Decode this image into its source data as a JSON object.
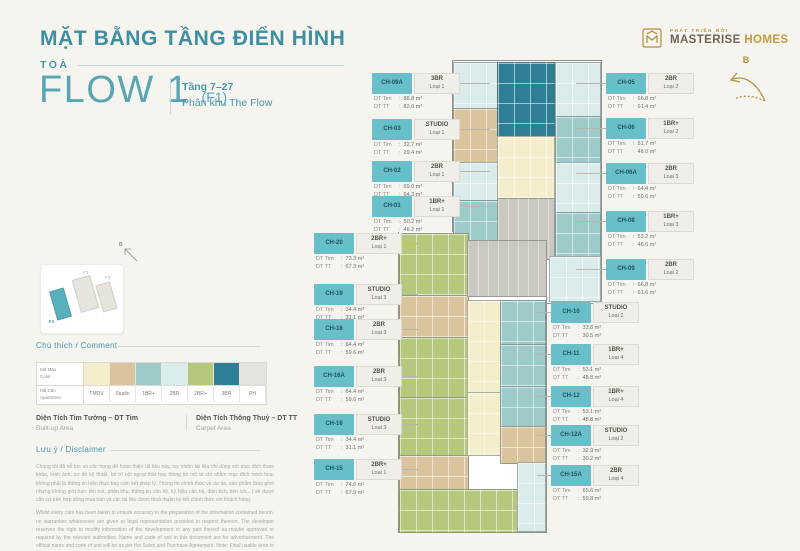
{
  "header": {
    "title": "MẶT BẰNG TẦNG ĐIỂN HÌNH",
    "tower_label": "TOÀ",
    "tower_name": "FLOW 1",
    "tower_code": "(F1)",
    "floors": "Tầng 7–27",
    "subzone": "Phân khu The Flow"
  },
  "logo": {
    "developed_by": "PHÁT TRIỂN BỞI",
    "brand_primary": "MASTERISE",
    "brand_secondary": "HOMES"
  },
  "compass": {
    "north_label": "B"
  },
  "minimap": {
    "north_label": "B",
    "buildings": [
      "F1",
      "F2",
      "F3"
    ]
  },
  "legend": {
    "heading": "Chú thích / Comment",
    "color_label_vi": "Mã Màu",
    "color_label_en": "Color",
    "apt_label_vi": "Mã Căn",
    "apt_label_en": "Apartment",
    "types": [
      {
        "label": "TMDV",
        "color": "#f5eecd"
      },
      {
        "label": "Studio",
        "color": "#d9c49d"
      },
      {
        "label": "1BR+",
        "color": "#9ccbca"
      },
      {
        "label": "2BR",
        "color": "#d9ebea"
      },
      {
        "label": "2BR+",
        "color": "#b5c87d"
      },
      {
        "label": "3BR",
        "color": "#2e7f96"
      },
      {
        "label": "PH",
        "color": "#e4e4df"
      }
    ]
  },
  "colors": {
    "core": "#cac8c0",
    "accent_teal": "#3e8fa1",
    "gold": "#b08d3f"
  },
  "measures": {
    "tim_vi": "Diện Tích Tim Tường – DT Tim",
    "tim_en": "Built-up Area",
    "tt_vi": "Diện Tích Thông Thuỷ – DT TT",
    "tt_en": "Carpet Area"
  },
  "labels": {
    "dt_tim": "DT Tim",
    "dt_tt": "DT TT",
    "colon": ":"
  },
  "disclaimer": {
    "heading": "Lưu ý / Disclaimer",
    "vi": "Chúng tôi đã nỗ lực và cẩn trọng để hoàn thiện tài liệu này, tuy nhiên tài liệu chỉ dùng với mục đích tham khảo, hình ảnh, sơ đồ kỹ thuật, bố trí nội ngoại thất hay thông tin mô tả chỉ nhằm mục đích minh hoạ, không phải là thông tin hiện thực hay cam kết pháp lý. Thông tin chính thức về dự án, sản phẩm (bao gồm nhưng không giới hạn: tên toà, phân khu, thông tin căn hộ, ký hiệu căn hộ, diện tích, tiện ích,...) sẽ được căn cứ trên hợp đồng mua bán và các tài liệu được thoả thuận ký kết chính thức với khách hàng.",
    "en": "Whilst every care has been taken to ensure accuracy in the preparation of the information contained herein, no warranties whatsoever are given or legal representation provided in respect thereon. The developer reserves the right to modify information of the development or any part thereof as maybe approved or required by the relevant authorities. Name and code of unit in this document are for advertisement. The official name and code of unit will be as per the Sales and Purchase Agreement. Note: Final usable area to be verified by surveyor."
  },
  "units": [
    {
      "code": "CH-09A",
      "type": "3BR",
      "variant": "Loại 1",
      "dt_tim": "88.8 m²",
      "dt_tt": "82.6 m²"
    },
    {
      "code": "CH-03",
      "type": "STUDIO",
      "variant": "Loại 1",
      "dt_tim": "32.7 m²",
      "dt_tt": "29.4 m²"
    },
    {
      "code": "CH-02",
      "type": "2BR",
      "variant": "Loại 1",
      "dt_tim": "69.0 m²",
      "dt_tt": "64.3 m²"
    },
    {
      "code": "CH-01",
      "type": "1BR+",
      "variant": "Loại 1",
      "dt_tim": "50.2 m²",
      "dt_tt": "46.2 m²"
    },
    {
      "code": "CH-20",
      "type": "2BR+",
      "variant": "Loại 1",
      "dt_tim": "73.3 m²",
      "dt_tt": "67.3 m²"
    },
    {
      "code": "CH-19",
      "type": "STUDIO",
      "variant": "Loại 3",
      "dt_tim": "34.4 m²",
      "dt_tt": "31.1 m²"
    },
    {
      "code": "CH-18",
      "type": "2BR",
      "variant": "Loại 3",
      "dt_tim": "64.4 m²",
      "dt_tt": "59.6 m²"
    },
    {
      "code": "CH-16A",
      "type": "2BR",
      "variant": "Loại 3",
      "dt_tim": "64.4 m²",
      "dt_tt": "59.6 m²"
    },
    {
      "code": "CH-16",
      "type": "STUDIO",
      "variant": "Loại 3",
      "dt_tim": "34.4 m²",
      "dt_tt": "31.1 m²"
    },
    {
      "code": "CH-15",
      "type": "2BR+",
      "variant": "Loại 1",
      "dt_tim": "74.6 m²",
      "dt_tt": "67.9 m²"
    },
    {
      "code": "CH-05",
      "type": "2BR",
      "variant": "Loại 2",
      "dt_tim": "66.8 m²",
      "dt_tt": "61.4 m²"
    },
    {
      "code": "CH-06",
      "type": "1BR+",
      "variant": "Loại 2",
      "dt_tim": "51.7 m²",
      "dt_tt": "48.0 m²"
    },
    {
      "code": "CH-06A",
      "type": "2BR",
      "variant": "Loại 3",
      "dt_tim": "64.4 m²",
      "dt_tt": "59.6 m²"
    },
    {
      "code": "CH-08",
      "type": "1BR+",
      "variant": "Loại 3",
      "dt_tim": "53.2 m²",
      "dt_tt": "48.6 m²"
    },
    {
      "code": "CH-09",
      "type": "2BR",
      "variant": "Loại 2",
      "dt_tim": "66.8 m²",
      "dt_tt": "61.6 m²"
    },
    {
      "code": "CH-10",
      "type": "STUDIO",
      "variant": "Loại 2",
      "dt_tim": "33.8 m²",
      "dt_tt": "30.5 m²"
    },
    {
      "code": "CH-11",
      "type": "1BR+",
      "variant": "Loại 4",
      "dt_tim": "53.1 m²",
      "dt_tt": "48.8 m²"
    },
    {
      "code": "CH-12",
      "type": "1BR+",
      "variant": "Loại 4",
      "dt_tim": "53.1 m²",
      "dt_tt": "48.8 m²"
    },
    {
      "code": "CH-12A",
      "type": "STUDIO",
      "variant": "Loại 2",
      "dt_tim": "32.9 m²",
      "dt_tt": "30.2 m²"
    },
    {
      "code": "CH-15A",
      "type": "2BR",
      "variant": "Loại 4",
      "dt_tim": "65.6 m²",
      "dt_tt": "59.8 m²"
    }
  ]
}
